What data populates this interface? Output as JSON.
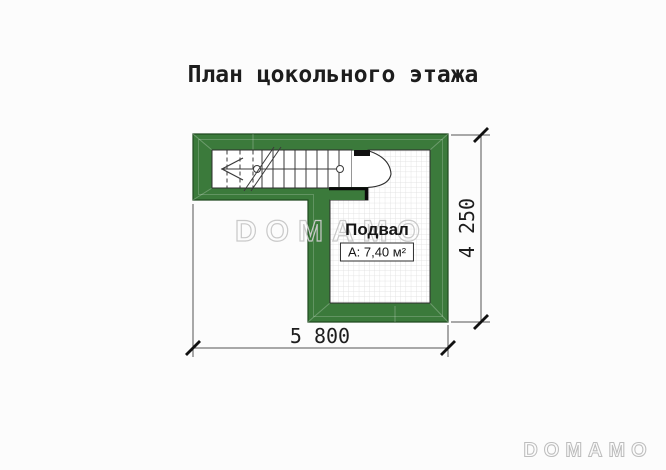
{
  "title": "План цокольного этажа",
  "plan": {
    "room_label": "Подвал",
    "room_area": "А: 7,40 м²",
    "dim_width": "5 800",
    "dim_height": "4 250"
  },
  "watermarks": {
    "center": "DOMAMO",
    "footer": "DOMAMO"
  },
  "colors": {
    "wall_fill": "#3b7a3b",
    "wall_outline": "#1f4a1f",
    "cut_edge": "#0a0a0a",
    "drawing_line": "#3a3a3a",
    "dim_line": "#555555",
    "tick": "#111111",
    "grid_line": "#dcdcdc",
    "watermark_stroke": "#c9c9c9",
    "text": "#1d1d1d"
  }
}
